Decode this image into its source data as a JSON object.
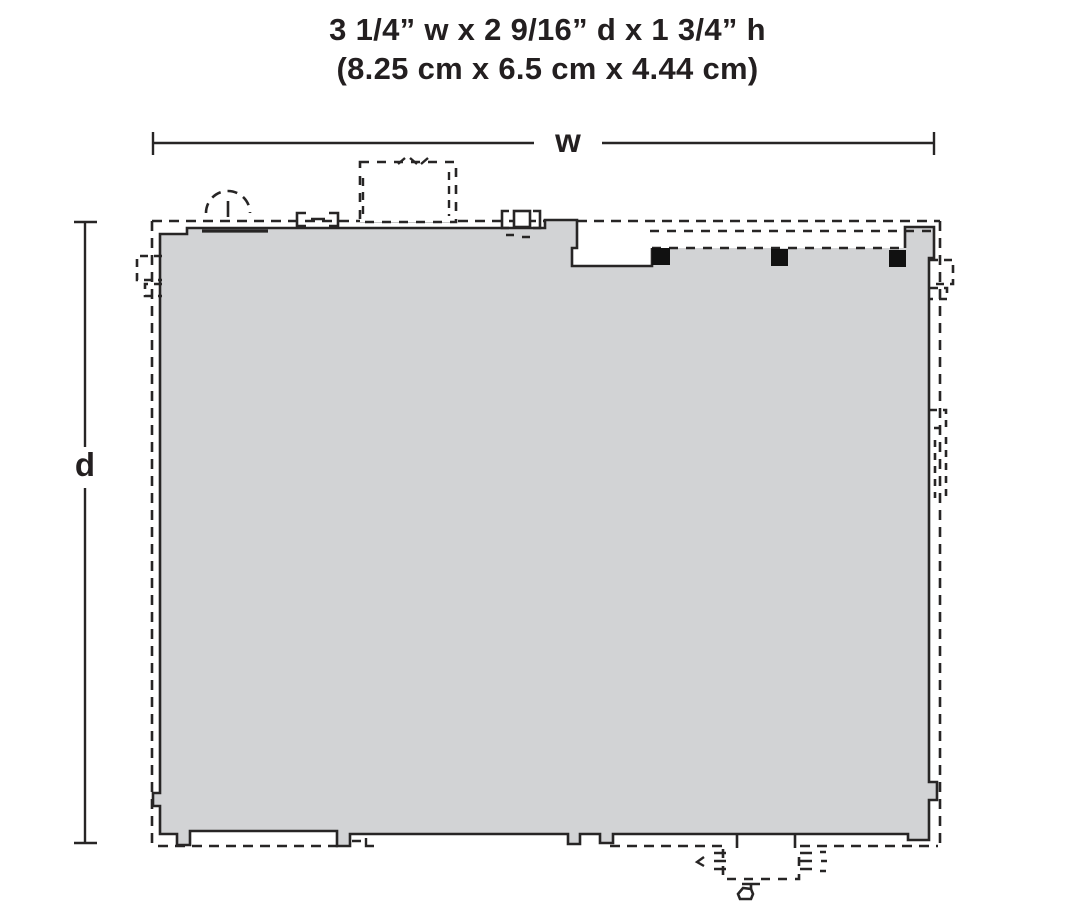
{
  "title": {
    "line1": "3 1/4” w x 2 9/16” d x 1 3/4” h",
    "line2": "(8.25 cm x 6.5 cm x 4.44 cm)"
  },
  "dimension_labels": {
    "width": "w",
    "depth": "d"
  },
  "colors": {
    "footprint_fill": "#d2d3d5",
    "line": "#272525",
    "post_fill": "#111111",
    "background": "#ffffff",
    "text": "#231f20"
  }
}
